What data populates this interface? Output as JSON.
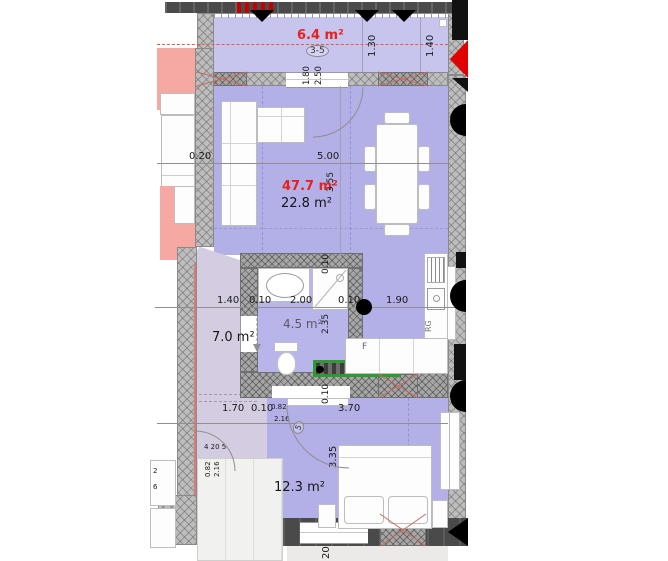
{
  "colors": {
    "room_fill": "#b2b0e7",
    "balcony_fill": "#c7c5ee",
    "bath_fill": "#b7b5ea",
    "hall_fill": "#d4cce1",
    "neighbor_fill": "#f6a9a2",
    "wall_dark": "#4a4a4a",
    "wall_hatch": "#a6a6a6",
    "area_label_red": "#e8211d",
    "kitchen_unit_green": "#2e9b31",
    "marker_red": "#e00000"
  },
  "rooms": {
    "balcony": {
      "area_red": "6.4 m²"
    },
    "living": {
      "area_red": "47.7 m²",
      "area": "22.8 m²"
    },
    "hall": {
      "area": "7.0 m²"
    },
    "bathroom": {
      "area": "4.5 m²"
    },
    "bedroom": {
      "area": "12.3 m²"
    }
  },
  "appliances": {
    "fridge": "F",
    "range": "RG"
  },
  "dims": {
    "balcony_depth_1": "1.30",
    "balcony_depth_2": "1.40",
    "balcony_door_w": "1.80",
    "balcony_door_h": "2.50",
    "balcony_door_tag": "3-5",
    "wall_offset": "0.20",
    "living_w": "5.00",
    "living_d": "3.55",
    "hall_w": "1.40",
    "wall_1": "0.10",
    "bath_w": "2.00",
    "wall_2": "0.10",
    "kitchen_w": "1.90",
    "bath_wall_top": "0.10",
    "bath_d": "2.35",
    "bath_wall_bottom": "0.10",
    "hall_w_lower": "1.70",
    "wall_3": "0.10",
    "bedroom_door_w": "0.82",
    "bedroom_door_h": "2.16",
    "bedroom_door_tag": "5",
    "bedroom_w": "3.70",
    "bedroom_d": "3.35",
    "entry_door_tag": "4 20 5",
    "entry_door_w": "0.82",
    "entry_door_h": "2.16",
    "bottom_window": "20",
    "edge_text_a": "2",
    "edge_text_b": "6"
  }
}
